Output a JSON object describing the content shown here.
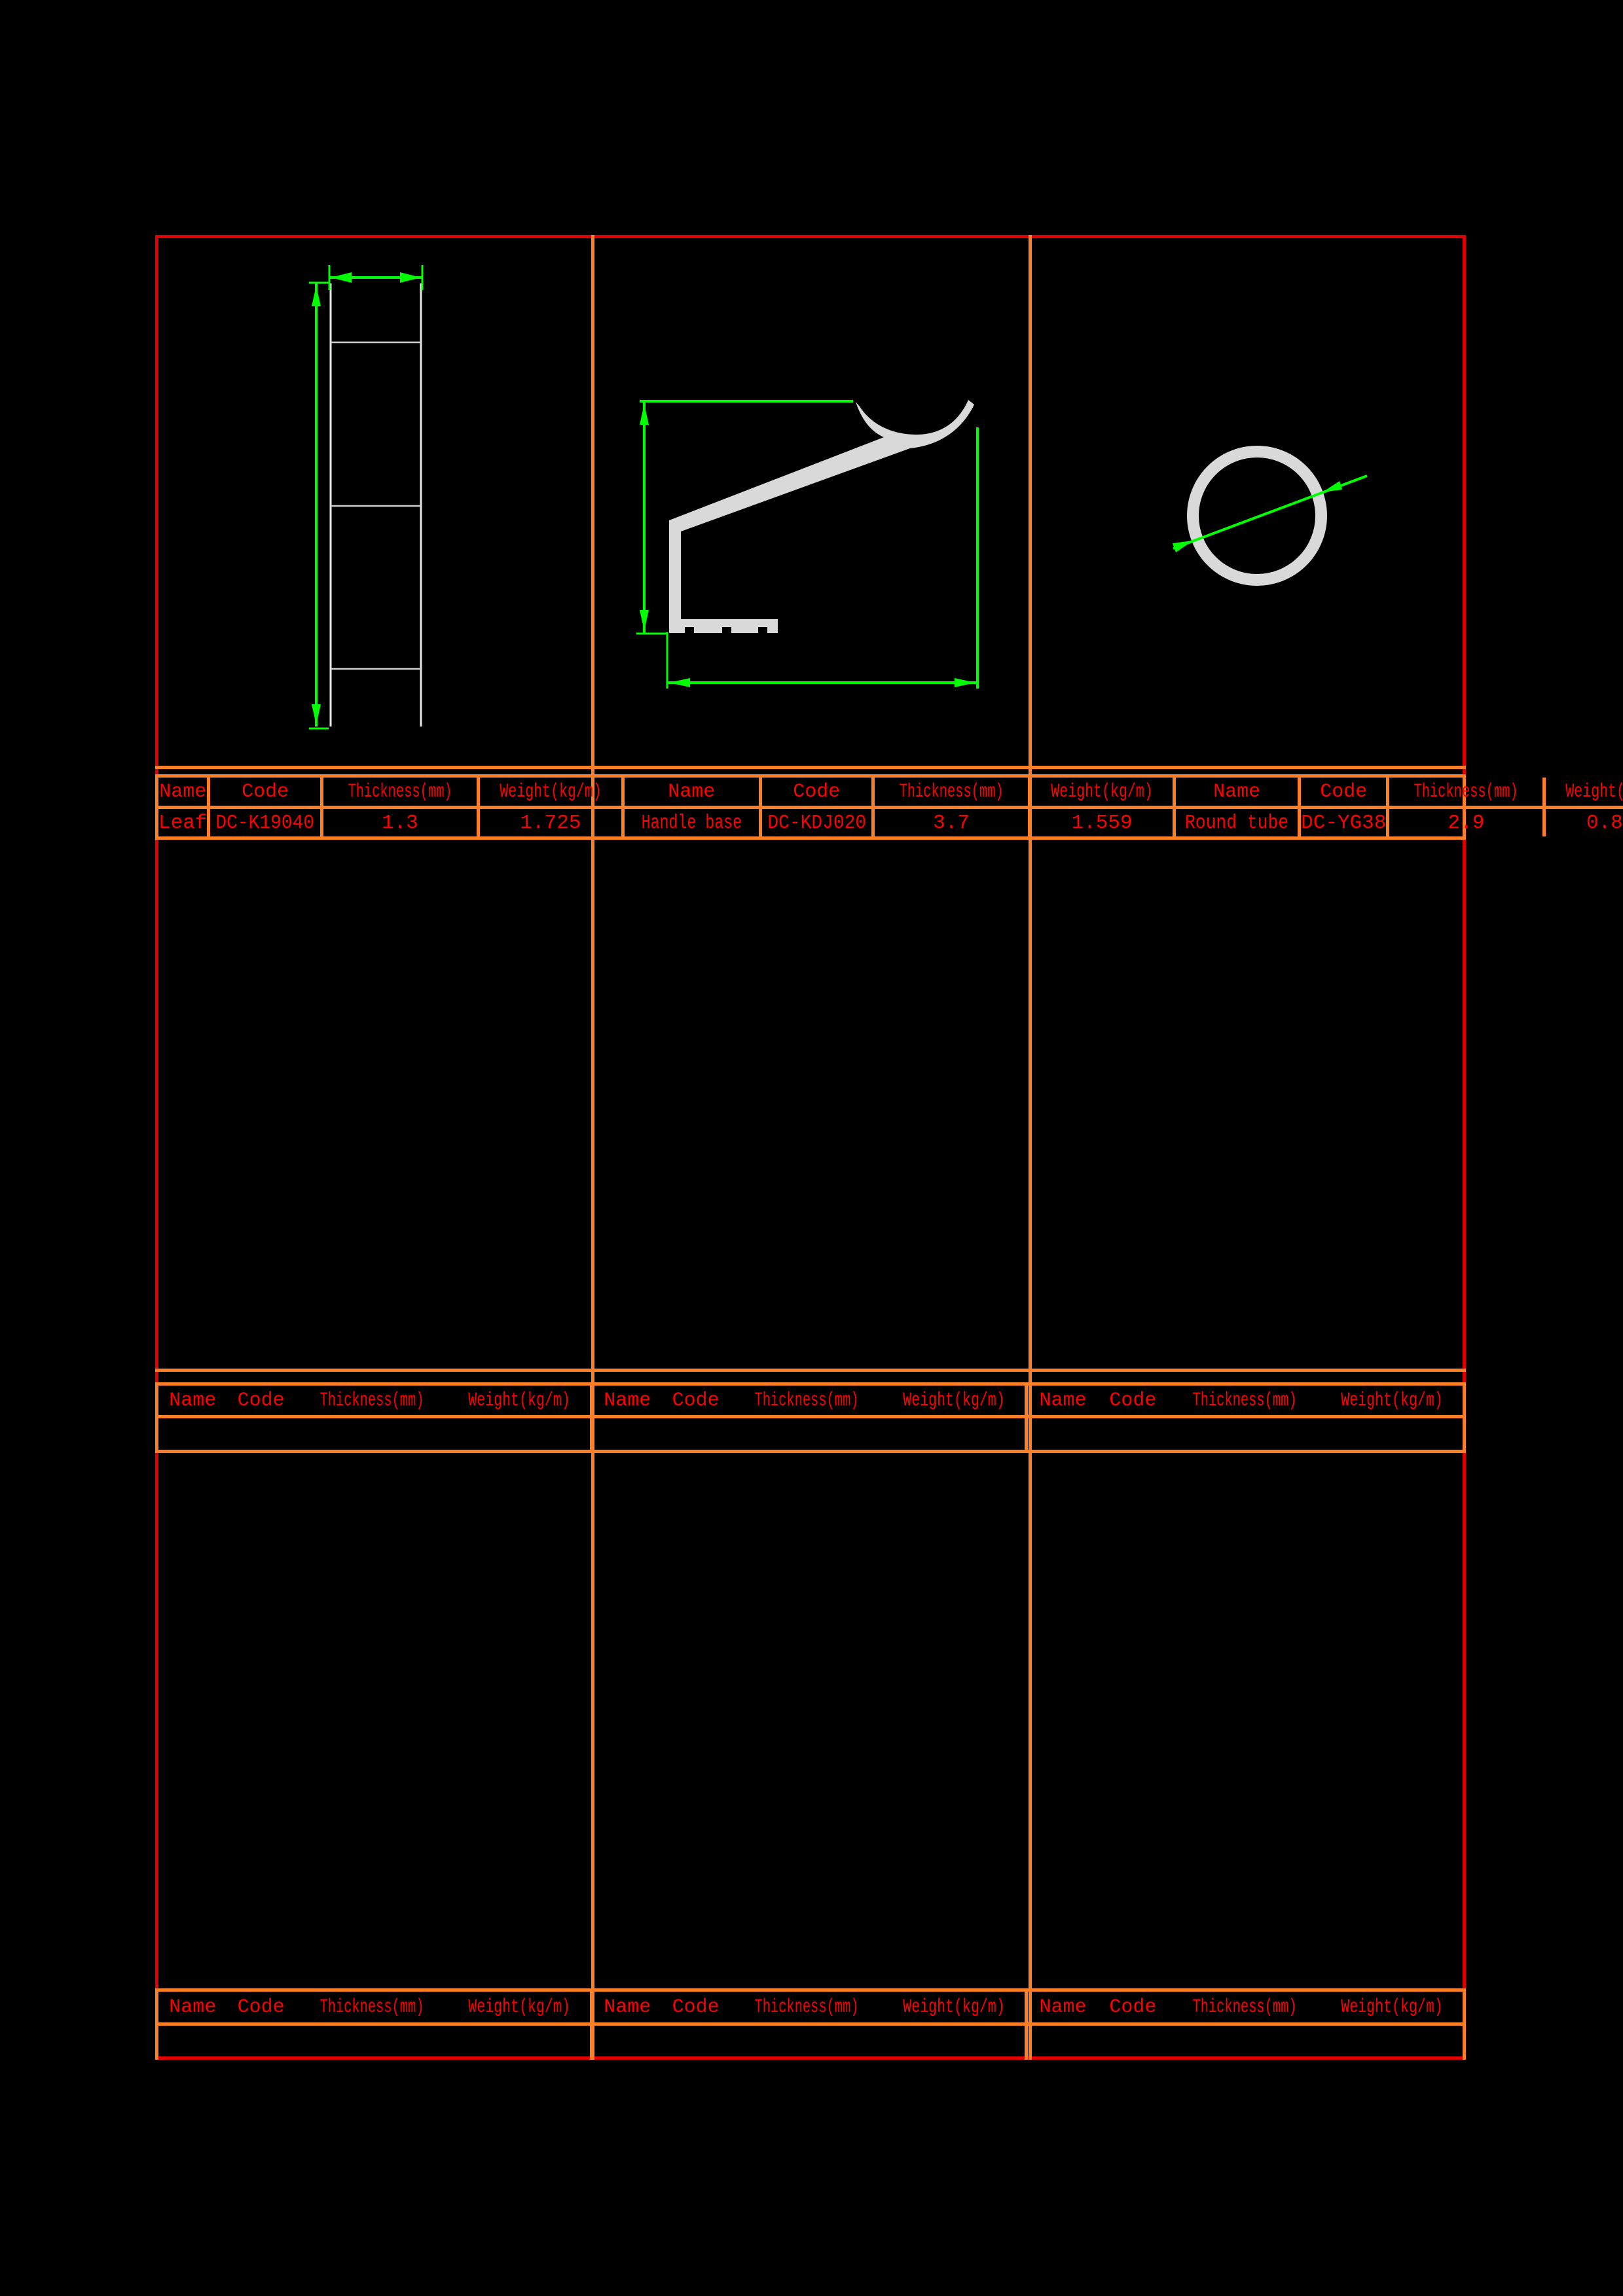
{
  "sheet": {
    "table_headers": [
      "Name",
      "Code",
      "Thickness(mm)",
      "Weight(kg/m)"
    ],
    "profiles": [
      {
        "name": "Leaf",
        "code": "DC-K19040",
        "thickness": "1.3",
        "weight": "1.725"
      },
      {
        "name": "Handle base",
        "code": "DC-KDJ020",
        "thickness": "3.7",
        "weight": "1.559"
      },
      {
        "name": "Round tube",
        "code": "DC-YG38",
        "thickness": "2.9",
        "weight": "0.863"
      }
    ],
    "colors": {
      "background": "#000000",
      "outer_border": "#e00000",
      "table_grid": "#ff7f27",
      "text": "#ff0000",
      "dimension": "#00ff00",
      "profile": "#d9d9d9"
    }
  }
}
